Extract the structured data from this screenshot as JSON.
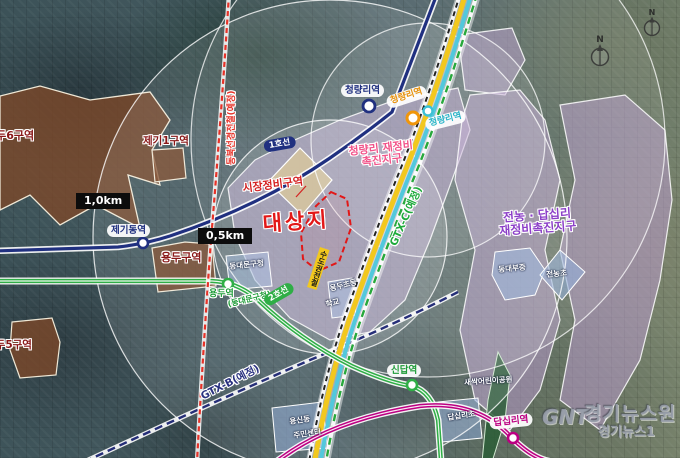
{
  "scale": {
    "km1": "1,0km",
    "km05": "0,5km"
  },
  "site": {
    "label": "대상지"
  },
  "zones": {
    "market": "시장정비구역",
    "cheongnyangni_line1": "청량리 재정비",
    "cheongnyangni_line2": "촉진지구",
    "jeonnong_line1": "전농 · 답십리",
    "jeonnong_line2": "재정비촉진지구",
    "yongdu6": "용두6구역",
    "jegi1": "제기1구역",
    "yongdu": "용두구역",
    "yongdu5": "용두5구역"
  },
  "facilities": {
    "gu_office": "동대문구청",
    "school_line1": "용두초등",
    "school_line2": "학교",
    "dongdaebu": "동대부중",
    "jeonnong_elem": "전농초",
    "yongsin_line1": "용신동",
    "yongsin_line2": "주민센터",
    "park": "새싹어린이공원",
    "dapsimni_elem": "답십리초"
  },
  "stations": {
    "jegidong": "제기동역",
    "cheongnyangni_line1": "청량리역",
    "cheongnyangni_jungang": "청량리역",
    "cheongnyangni_gyeongchun": "청량리역",
    "yongdu": "용두역",
    "yongdu_sub": "(동대문구청)",
    "sindap": "신답역",
    "dapsimni": "답십리역"
  },
  "lines": {
    "line1": "1호선",
    "line2": "2호선",
    "gtxb": "GTX-B(예정)",
    "gtxc": "GTX-C(예정)",
    "metro": "수도권전철",
    "dongbuk": "동북선경전철(예정)"
  },
  "compass": {
    "n": "N"
  },
  "watermark": {
    "logo": "GNT",
    "title": "경기뉴스원",
    "subtitle": "경기뉴스1"
  },
  "colors": {
    "line1_navy": "#203080",
    "line2_green": "#2fae46",
    "line5_magenta": "#bc0082",
    "rail_yellow": "#f2c81e",
    "rail_teal": "#52c8dc",
    "gtx_green": "#28a83c",
    "dongbuk_red": "#e63228",
    "gtxb_navy": "#252e78",
    "zone_brown": "#7d4828",
    "zone_purple": "#bea0d2",
    "zone_blue": "#8caad8",
    "site_red": "#e21818",
    "label_pink": "#f2548a",
    "label_purple": "#8c3fc8"
  }
}
